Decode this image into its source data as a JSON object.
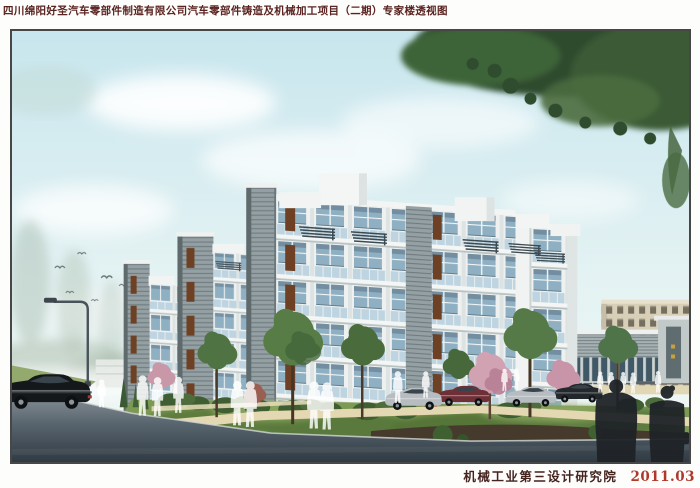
{
  "sheet": {
    "title": "四川绵阳好圣汽车零部件制造有限公司汽车零部件铸造及机械加工项目（二期）专家楼透视图",
    "footer": {
      "institute": "机械工业第三设计研究院",
      "date": "2011.03"
    }
  },
  "palette": {
    "page_bg": "#fdfdfb",
    "title_color": "#5a2320",
    "institute_color": "#45231f",
    "date_color": "#b0372c",
    "frame_border": "#474747",
    "sky_top": "#c8e6ee",
    "sky_mid": "#e3f2f3",
    "sky_low": "#f3f8f5",
    "foliage_dark": "#2f4c2e",
    "foliage_mid": "#4a6c3e",
    "facade_light": "#eef1f0",
    "tower_gray": "#94a0a3",
    "wood_accent": "#6e4124",
    "balcony_glass": "#b9d2df",
    "window_glass": "#8fb0c2",
    "lawn_green": "#7d9a54",
    "path_beige": "#e4d8b2",
    "road_dark": "#2f3a43",
    "beige_building": "#d7cfb8",
    "admin_gray": "#a7b1b3",
    "car_black": "#15181b",
    "car_silver": "#b6bcc0",
    "car_maroon": "#6e3036"
  }
}
